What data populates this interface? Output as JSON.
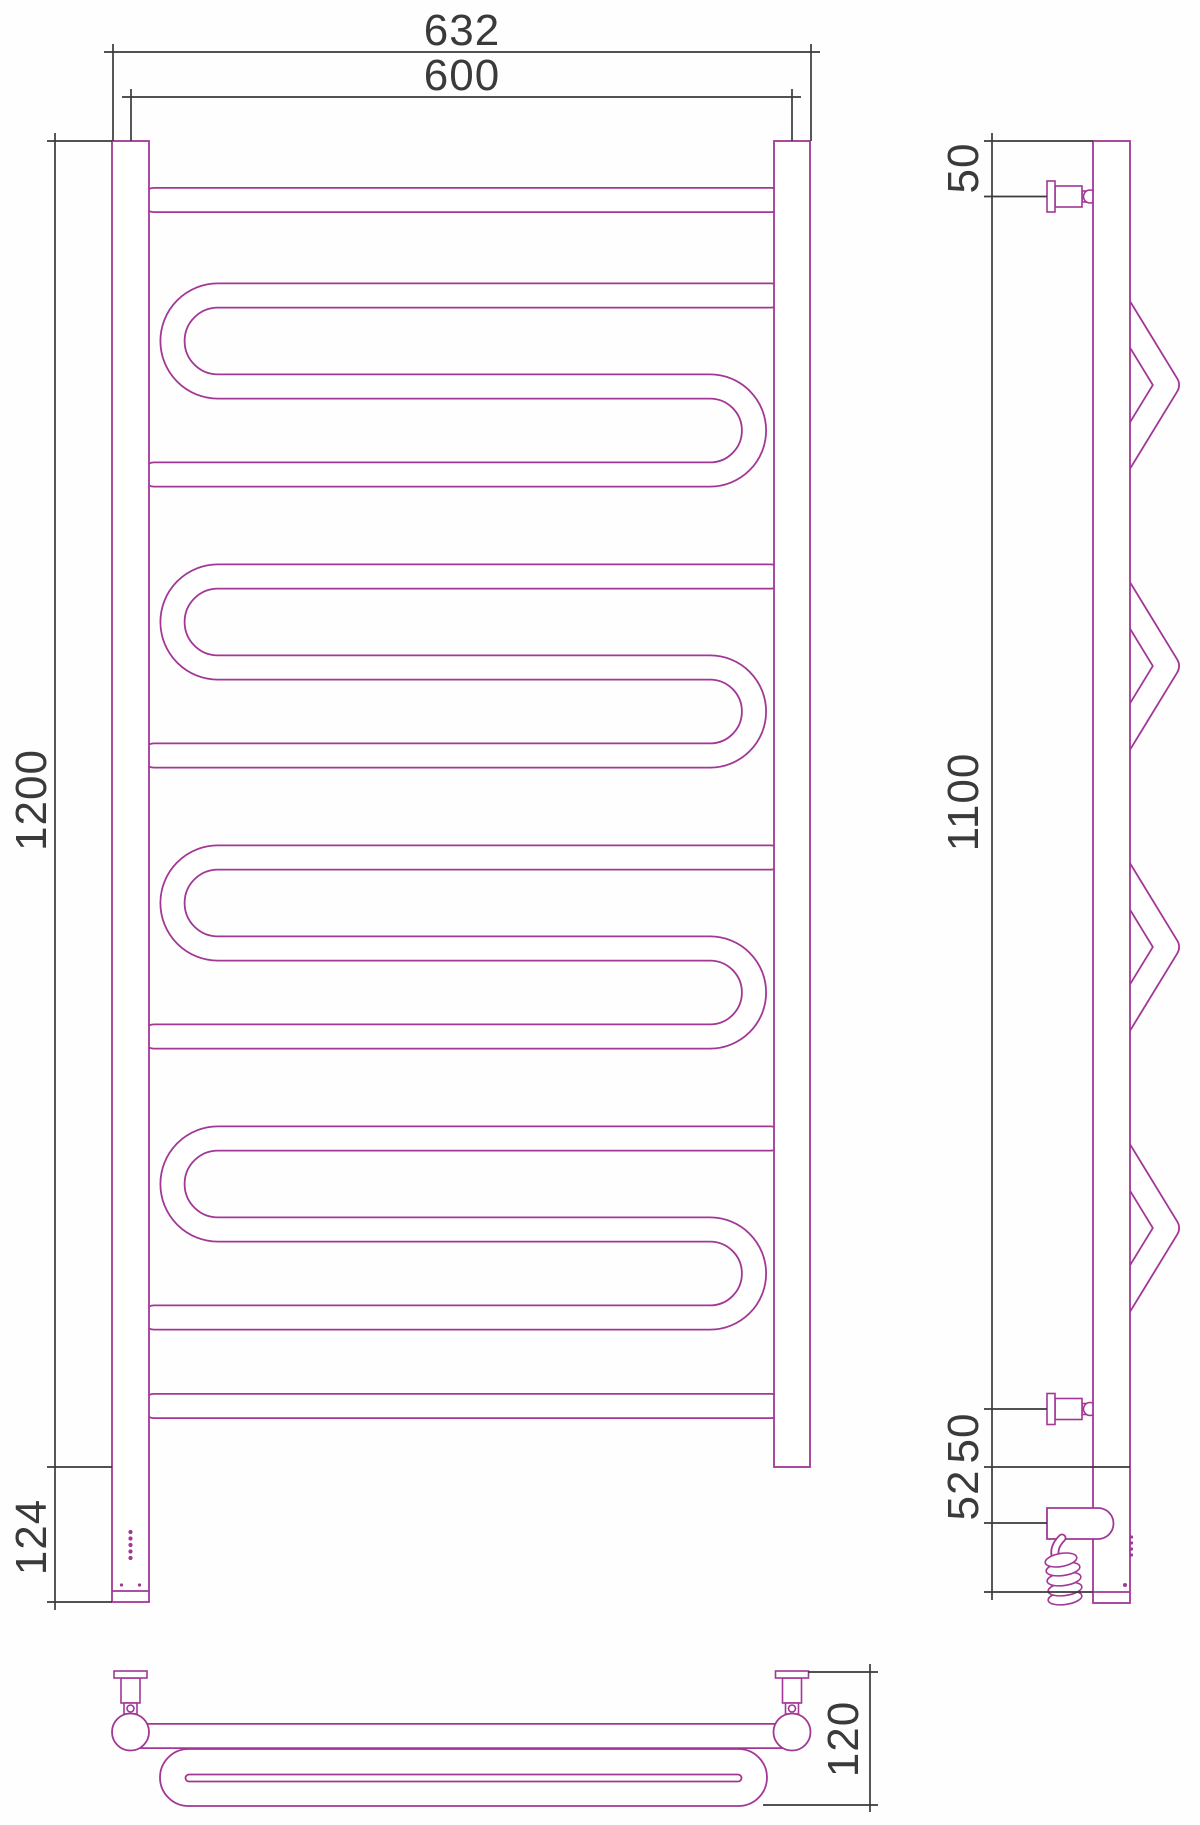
{
  "drawing": {
    "title": "heated-towel-rail-technical-drawing",
    "colors": {
      "outline": "#A23795",
      "dimension": "#3a3a3a",
      "background": "#ffffff"
    },
    "views": {
      "front": {
        "dims": {
          "overall_width": "632",
          "rail_spacing": "600",
          "height": "1200",
          "lower_section": "124"
        }
      },
      "side": {
        "dims": {
          "top_bracket_offset": "50",
          "bracket_span": "1100",
          "bottom_bracket_offset": "50",
          "cable_box_offset": "52"
        }
      },
      "bottom": {
        "dims": {
          "depth": "120"
        }
      }
    }
  }
}
